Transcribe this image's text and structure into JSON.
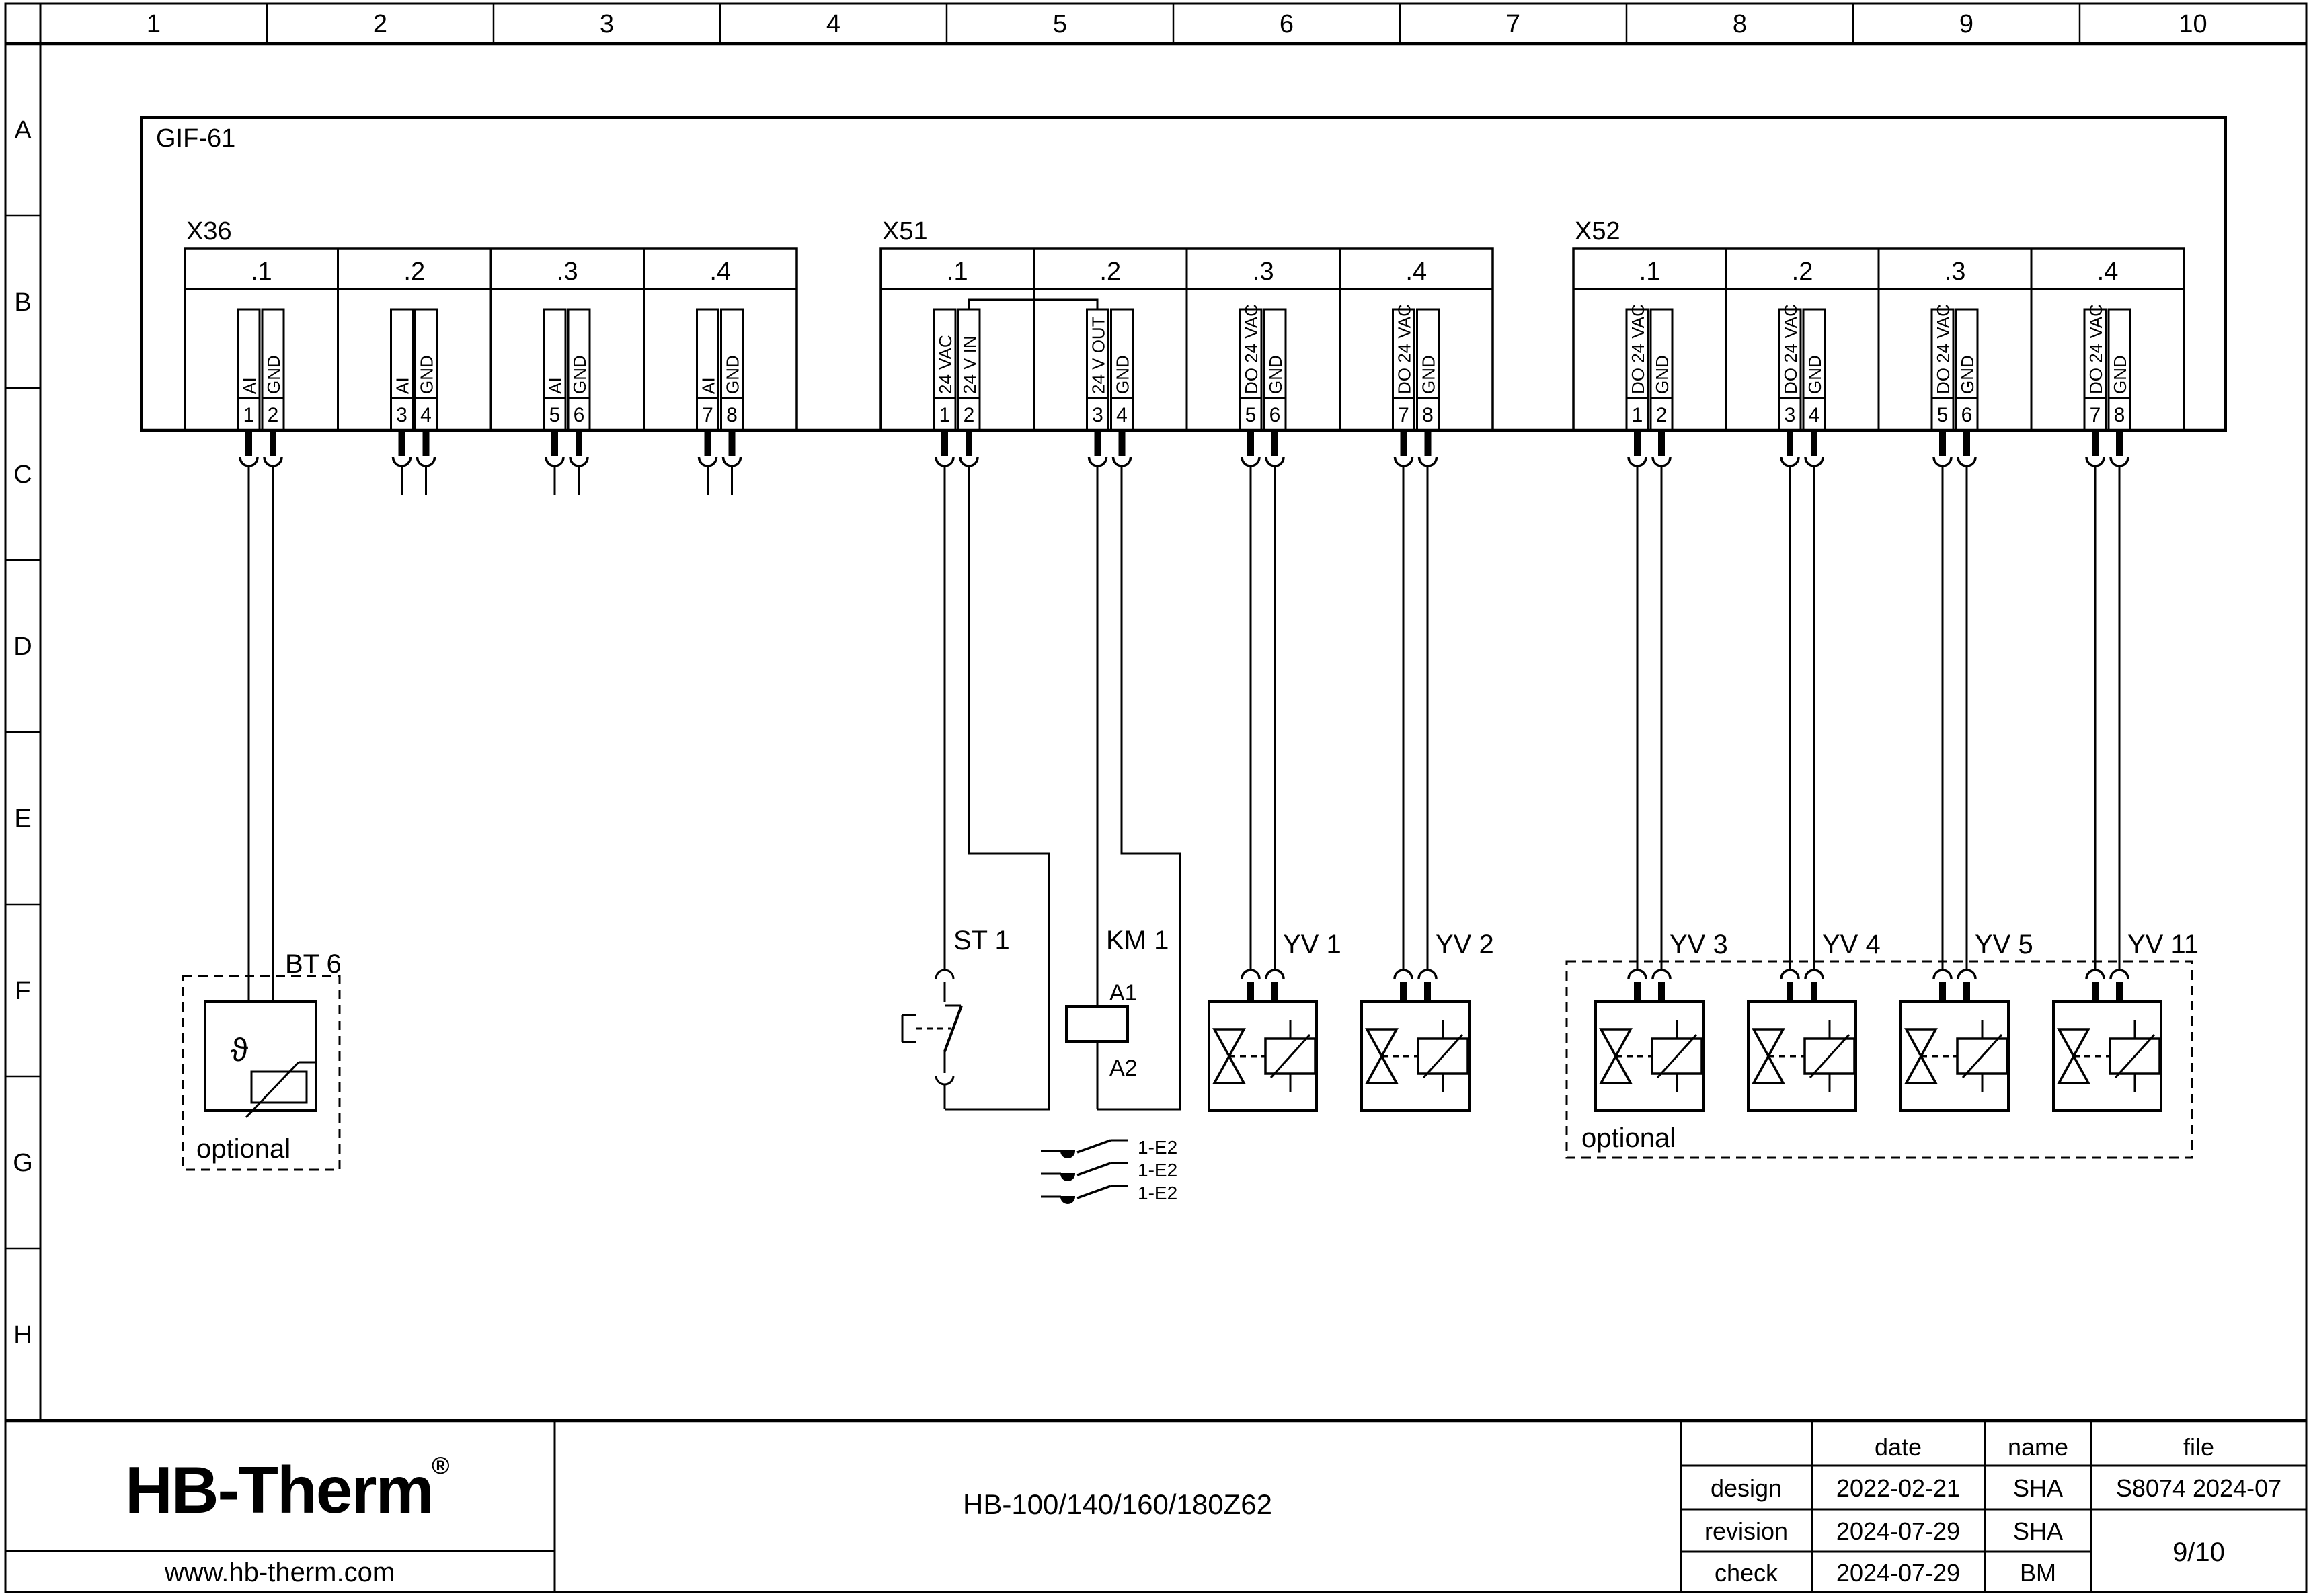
{
  "frame": {
    "columns": [
      "1",
      "2",
      "3",
      "4",
      "5",
      "6",
      "7",
      "8",
      "9",
      "10"
    ],
    "rows": [
      "A",
      "B",
      "C",
      "D",
      "E",
      "F",
      "G",
      "H"
    ]
  },
  "module": {
    "label": "GIF-61"
  },
  "connectors": [
    {
      "label": "X36",
      "sections": [
        {
          "label": ".1",
          "pins": [
            {
              "no": "1",
              "signal": "AI"
            },
            {
              "no": "2",
              "signal": "GND"
            }
          ]
        },
        {
          "label": ".2",
          "pins": [
            {
              "no": "3",
              "signal": "AI"
            },
            {
              "no": "4",
              "signal": "GND"
            }
          ]
        },
        {
          "label": ".3",
          "pins": [
            {
              "no": "5",
              "signal": "AI"
            },
            {
              "no": "6",
              "signal": "GND"
            }
          ]
        },
        {
          "label": ".4",
          "pins": [
            {
              "no": "7",
              "signal": "AI"
            },
            {
              "no": "8",
              "signal": "GND"
            }
          ]
        }
      ]
    },
    {
      "label": "X51",
      "sections": [
        {
          "label": ".1",
          "pins": [
            {
              "no": "1",
              "signal": "24 VAC"
            },
            {
              "no": "2",
              "signal": "24 V IN"
            }
          ]
        },
        {
          "label": ".2",
          "pins": [
            {
              "no": "3",
              "signal": "24 V OUT"
            },
            {
              "no": "4",
              "signal": "GND"
            }
          ]
        },
        {
          "label": ".3",
          "pins": [
            {
              "no": "5",
              "signal": "DO 24 VAC"
            },
            {
              "no": "6",
              "signal": "GND"
            }
          ]
        },
        {
          "label": ".4",
          "pins": [
            {
              "no": "7",
              "signal": "DO 24 VAC"
            },
            {
              "no": "8",
              "signal": "GND"
            }
          ]
        }
      ]
    },
    {
      "label": "X52",
      "sections": [
        {
          "label": ".1",
          "pins": [
            {
              "no": "1",
              "signal": "DO 24 VAC"
            },
            {
              "no": "2",
              "signal": "GND"
            }
          ]
        },
        {
          "label": ".2",
          "pins": [
            {
              "no": "3",
              "signal": "DO 24 VAC"
            },
            {
              "no": "4",
              "signal": "GND"
            }
          ]
        },
        {
          "label": ".3",
          "pins": [
            {
              "no": "5",
              "signal": "DO 24 VAC"
            },
            {
              "no": "6",
              "signal": "GND"
            }
          ]
        },
        {
          "label": ".4",
          "pins": [
            {
              "no": "7",
              "signal": "DO 24 VAC"
            },
            {
              "no": "8",
              "signal": "GND"
            }
          ]
        }
      ]
    }
  ],
  "components": {
    "bt6": {
      "label": "BT 6",
      "symbol": "ϑ",
      "note": "optional"
    },
    "st1": {
      "label": "ST 1"
    },
    "km1": {
      "label": "KM 1",
      "a1": "A1",
      "a2": "A2"
    },
    "km1_contacts": [
      "1-E2",
      "1-E2",
      "1-E2"
    ],
    "valves": [
      {
        "label": "YV 1"
      },
      {
        "label": "YV 2"
      },
      {
        "label": "YV 3"
      },
      {
        "label": "YV 4"
      },
      {
        "label": "YV 5"
      },
      {
        "label": "YV 11"
      }
    ],
    "optional_group_note": "optional"
  },
  "title_block": {
    "logo": {
      "text": "HB-Therm",
      "reg": "®",
      "url": "www.hb-therm.com",
      "color": "#1e2a47"
    },
    "doc_title": "HB-100/140/160/180Z62",
    "table": {
      "date_header": "date",
      "name_header": "name",
      "file_header": "file",
      "rows": [
        {
          "label": "design",
          "date": "2022-02-21",
          "name": "SHA"
        },
        {
          "label": "revision",
          "date": "2024-07-29",
          "name": "SHA"
        },
        {
          "label": "check",
          "date": "2024-07-29",
          "name": "BM"
        }
      ],
      "file_value": "S8074 2024-07",
      "page": "9/10"
    }
  }
}
